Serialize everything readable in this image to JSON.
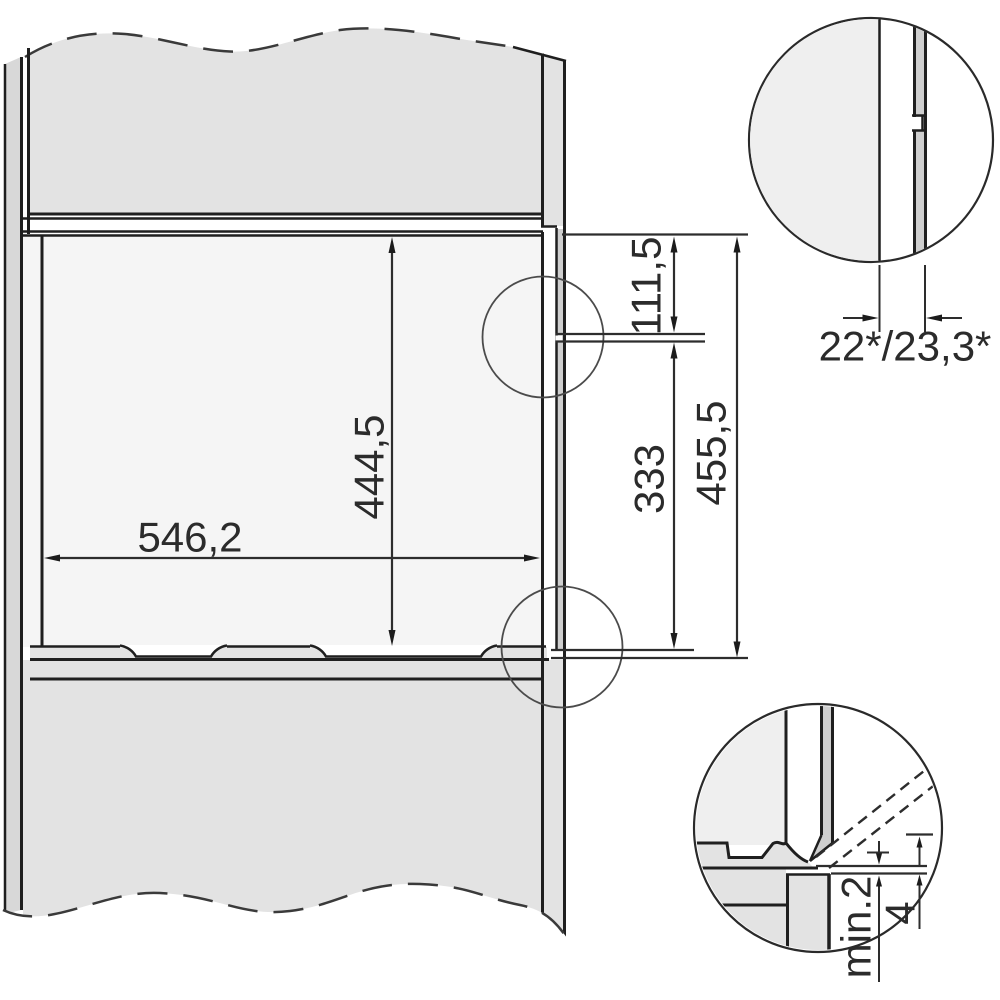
{
  "page": {
    "background": "#ffffff",
    "line_color": "#1f1f1f",
    "fill_gray": "#e3e3e3"
  },
  "drawing": {
    "kind": "built-in appliance niche installation cross-section",
    "niche": {
      "depth_label": "546,2",
      "height_label": "444,5"
    },
    "front_heights": {
      "upper": "111,5",
      "lower": "333",
      "total": "455,5"
    },
    "detail_top_right": {
      "protrusion_label": "22*/23,3*"
    },
    "detail_bottom_right": {
      "min_gap_label": "min.2",
      "offset_label": "4"
    }
  }
}
